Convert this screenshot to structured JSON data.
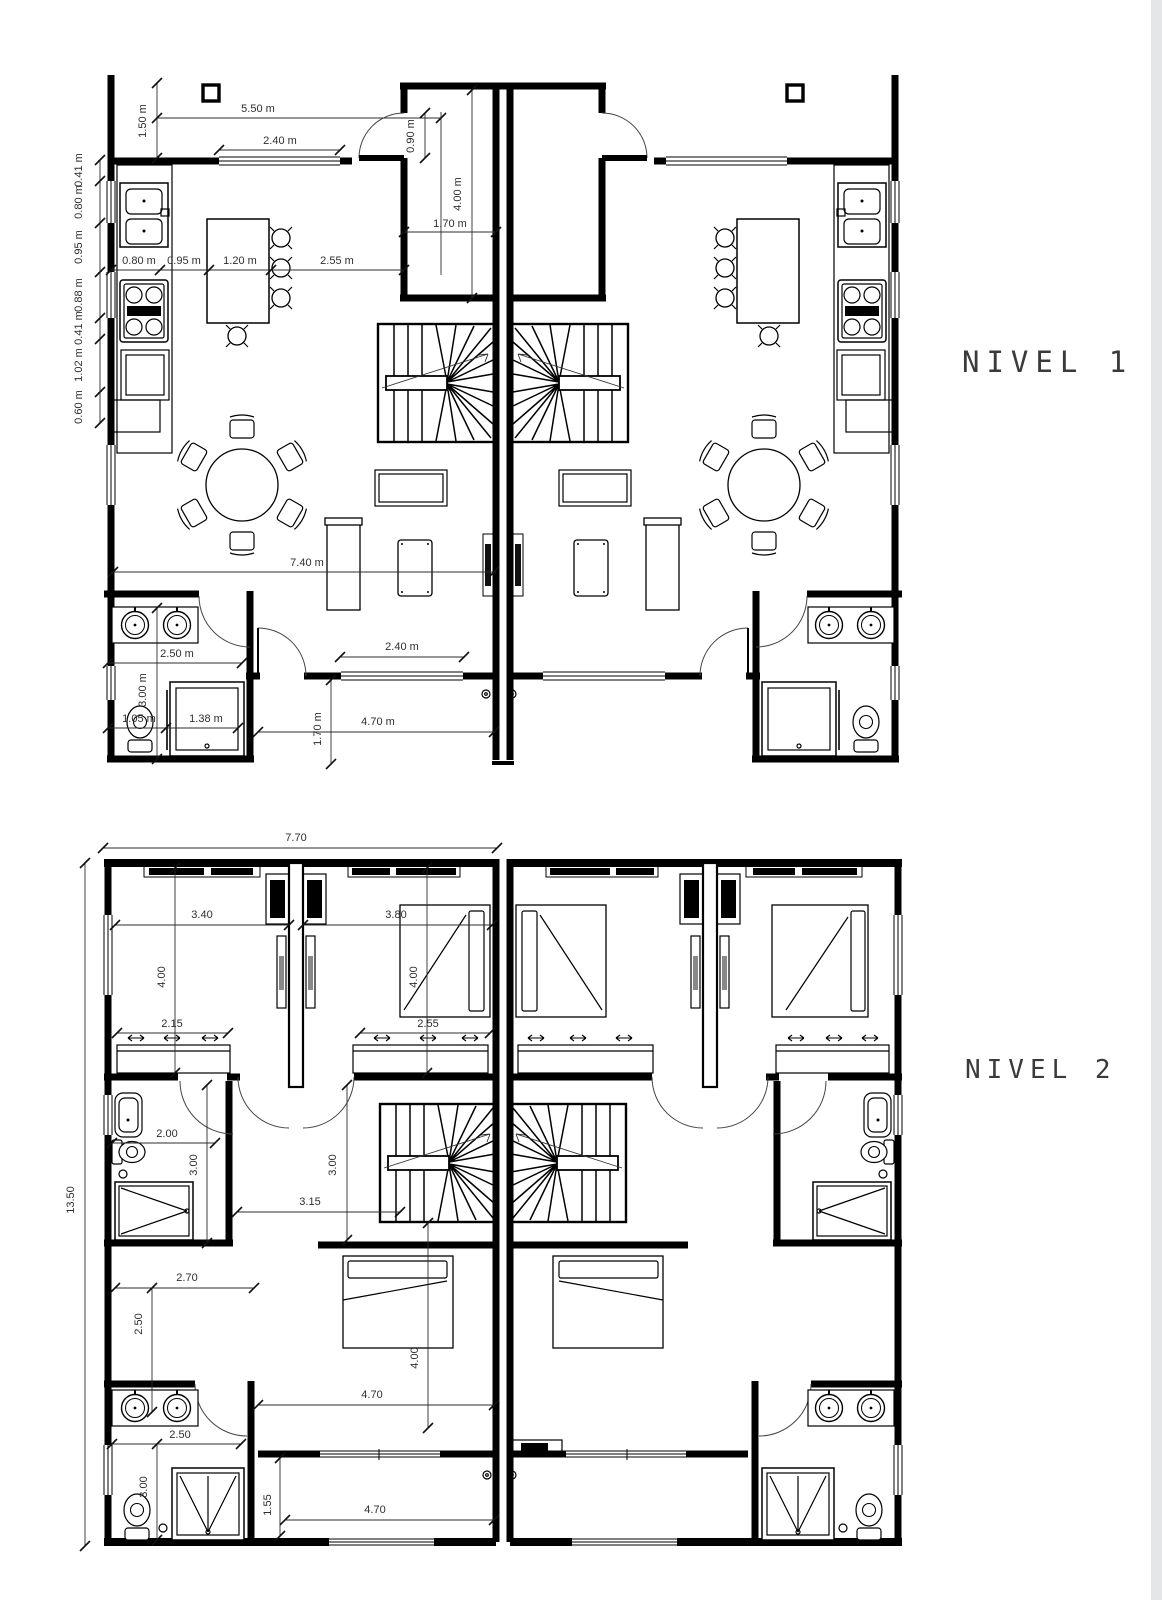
{
  "page": {
    "background": "#ffffff",
    "edge_shade": "#e4e6e8",
    "line_color": "#000000",
    "dim_color": "#2e2e2e"
  },
  "levels": [
    {
      "label": "NIVEL 1",
      "dims": {
        "top_width": "5.50 m",
        "top_window": "2.40 m",
        "front_setback": "1.50 m",
        "entry_door": "0.90 m",
        "entry_length": "4.00 m",
        "entry_width": "1.70 m",
        "counter": "0.80 m",
        "aisle": "0.95 m",
        "island": "1.20 m",
        "island_to_wall": "2.55 m",
        "side": [
          "0.41 m",
          "0.80 m",
          "0.95 m",
          "0.88 m",
          "0.41 m",
          "1.02 m",
          "0.60 m"
        ],
        "living_width": "7.40 m",
        "bath_width": "2.50 m",
        "bath_depth": "3.00 m",
        "wc_width": "1.05 m",
        "shower_width": "1.38 m",
        "rear_window": "2.40 m",
        "rear_width": "4.70 m",
        "rear_depth": "1.70 m"
      }
    },
    {
      "label": "NIVEL 2",
      "dims": {
        "total_width": "7.70",
        "total_depth": "13.50",
        "bed1_width": "3.40",
        "bed1_depth": "4.00",
        "closet1_width": "2.15",
        "bed2_width": "3.80",
        "bed2_depth": "4.00",
        "closet2_width": "2.55",
        "bath1_width": "2.00",
        "bath1_depth": "3.00",
        "hall_depth": "3.00",
        "hall_width": "3.15",
        "bed3_width": "2.70",
        "bed3_side": "2.50",
        "bed3_depth": "4.00",
        "mid_width": "4.70",
        "bath2_width": "2.50",
        "bath2_depth": "3.00",
        "balcony_depth": "1.55",
        "balcony_width": "4.70"
      }
    }
  ]
}
